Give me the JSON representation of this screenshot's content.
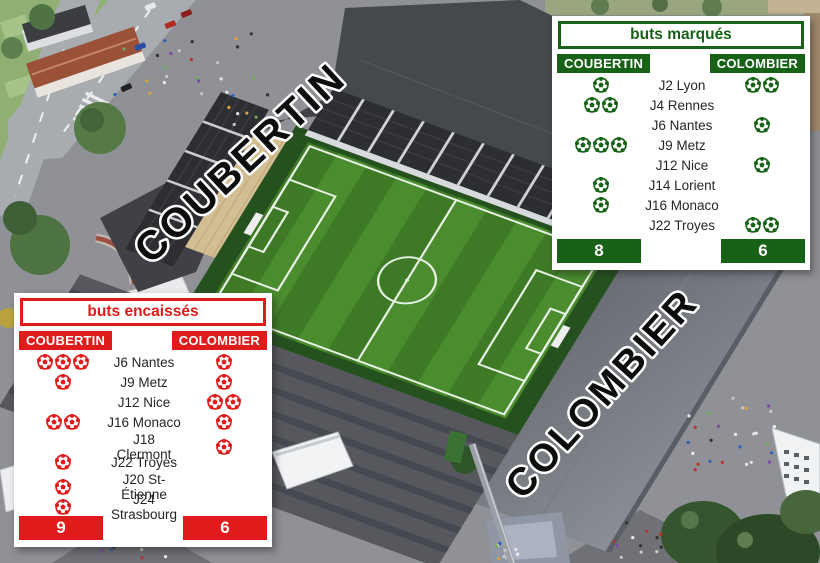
{
  "scene": {
    "stand_labels": [
      "COUBERTIN",
      "COLOMBIER"
    ],
    "pitch_green": "#47892c",
    "roof_gray": "#45484d"
  },
  "tables": {
    "scored": {
      "title": "buts marqués",
      "accent": "#176217",
      "columns": [
        "COUBERTIN",
        "COLOMBIER"
      ],
      "rows": [
        {
          "label": "J2 Lyon",
          "left": 1,
          "right": 2
        },
        {
          "label": "J4 Rennes",
          "left": 2,
          "right": 0
        },
        {
          "label": "J6 Nantes",
          "left": 0,
          "right": 1
        },
        {
          "label": "J9 Metz",
          "left": 3,
          "right": 0
        },
        {
          "label": "J12 Nice",
          "left": 0,
          "right": 1
        },
        {
          "label": "J14 Lorient",
          "left": 1,
          "right": 0
        },
        {
          "label": "J16 Monaco",
          "left": 1,
          "right": 0
        },
        {
          "label": "J22 Troyes",
          "left": 0,
          "right": 2
        }
      ],
      "totals": {
        "left": "8",
        "right": "6"
      }
    },
    "conceded": {
      "title": "buts encaissés",
      "accent": "#df1b1b",
      "columns": [
        "COUBERTIN",
        "COLOMBIER"
      ],
      "rows": [
        {
          "label": "J6 Nantes",
          "left": 3,
          "right": 1
        },
        {
          "label": "J9 Metz",
          "left": 1,
          "right": 1
        },
        {
          "label": "J12 Nice",
          "left": 0,
          "right": 2
        },
        {
          "label": "J16 Monaco",
          "left": 2,
          "right": 1
        },
        {
          "label": "J18 Clermont",
          "left": 0,
          "right": 1
        },
        {
          "label": "J22 Troyes",
          "left": 1,
          "right": 0
        },
        {
          "label": "J20 St-Étienne",
          "left": 1,
          "right": 0
        },
        {
          "label": "J24 Strasbourg",
          "left": 1,
          "right": 0
        }
      ],
      "totals": {
        "left": "9",
        "right": "6"
      }
    }
  },
  "chart_data": [
    {
      "type": "table",
      "title": "buts marqués",
      "columns": [
        "COUBERTIN",
        "COLOMBIER"
      ],
      "categories": [
        "J2 Lyon",
        "J4 Rennes",
        "J6 Nantes",
        "J9 Metz",
        "J12 Nice",
        "J14 Lorient",
        "J16 Monaco",
        "J22 Troyes"
      ],
      "series": [
        {
          "name": "COUBERTIN",
          "values": [
            1,
            2,
            0,
            3,
            0,
            1,
            1,
            0
          ]
        },
        {
          "name": "COLOMBIER",
          "values": [
            2,
            0,
            1,
            0,
            1,
            0,
            0,
            2
          ]
        }
      ],
      "totals": {
        "COUBERTIN": 8,
        "COLOMBIER": 6
      }
    },
    {
      "type": "table",
      "title": "buts encaissés",
      "columns": [
        "COUBERTIN",
        "COLOMBIER"
      ],
      "categories": [
        "J6 Nantes",
        "J9 Metz",
        "J12 Nice",
        "J16 Monaco",
        "J18 Clermont",
        "J22 Troyes",
        "J20 St-Étienne",
        "J24 Strasbourg"
      ],
      "series": [
        {
          "name": "COUBERTIN",
          "values": [
            3,
            1,
            0,
            2,
            0,
            1,
            1,
            1
          ]
        },
        {
          "name": "COLOMBIER",
          "values": [
            1,
            1,
            2,
            1,
            1,
            0,
            0,
            0
          ]
        }
      ],
      "totals": {
        "COUBERTIN": 9,
        "COLOMBIER": 6
      }
    }
  ]
}
